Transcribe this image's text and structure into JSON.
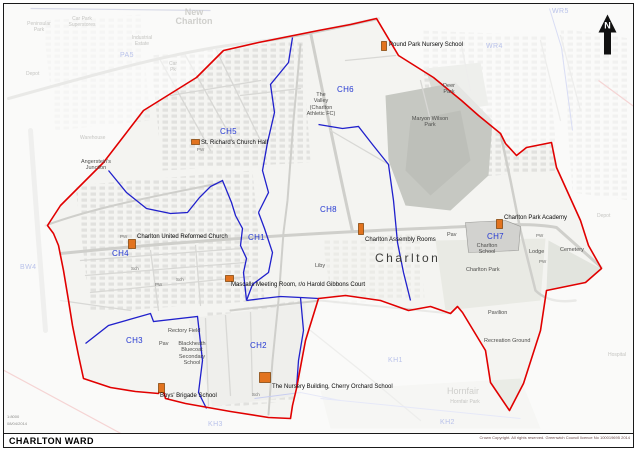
{
  "title_bar": {
    "title": "CHARLTON WARD",
    "copyright": "Crown Copyright. All rights reserved. Greenwich Council licence No 100019695 2014"
  },
  "meta": {
    "scale": "1:8000",
    "date": "08/04/2014"
  },
  "north": {
    "label": "N"
  },
  "districts": {
    "ch1": "CH1",
    "ch2": "CH2",
    "ch3": "CH3",
    "ch4": "CH4",
    "ch5": "CH5",
    "ch6": "CH6",
    "ch7": "CH7",
    "ch8": "CH8"
  },
  "outside_districts": {
    "pa5": "PA5",
    "wr4": "WR4",
    "wr5": "WR5",
    "bw4": "BW4",
    "kh1": "KH1",
    "kh2": "KH2",
    "kh3": "KH3"
  },
  "pois": {
    "pound_park": "Pound Park Nursery School",
    "st_richards": "St. Richard's Church Hall",
    "charlton_united": "Charlton United Reformed Church",
    "assembly": "Charlton Assembly Rooms",
    "mascalls": "Mascalls Meeting Room, r/o Harold Gibbons Court",
    "academy": "Charlton Park Academy",
    "boys": "Boys' Brigade School",
    "nursery": "The Nursery Building, Cherry Orchard School"
  },
  "places": {
    "deer_park": "Deer\nPark",
    "maryon": "Maryon Wilson\nPark",
    "valley": "The\nValley\n(Charlton\nAthletic FC)",
    "angersteins": "Angerstein's\nJunction",
    "rectory": "Rectory Field",
    "blackheath": "Blackheath\nBluecoat\nSecondary\nSchool",
    "pav": "Pav",
    "charlton_school": "Charlton\nSchool",
    "charlton_park": "Charlton Park",
    "cemetery": "Cemetery",
    "lodge": "Lodge",
    "pavilion": "Pavilion",
    "recreation": "Recreation Ground",
    "liby": "Liby",
    "charlton_big": "Charlton"
  },
  "faint": {
    "new_charlton": "New\nCharlton",
    "peninsular_park": "Peninsular\nPark",
    "car_park": "Car Park\nSuperstores",
    "industrial_estate": "Industrial\nEstate",
    "depot_left": "Depot",
    "depot_right": "Depot",
    "car_pk": "Car\nPk",
    "warehouse": "Warehouse",
    "hospital": "Hospital",
    "hornfair": "Hornfair",
    "hornfair_park": "Hornfair Park"
  },
  "small": {
    "pw": "PW",
    "sch": "Sch"
  },
  "colors": {
    "ward_boundary": "#e10000",
    "district_boundary": "#2020cc",
    "district_label": "#2438d2",
    "poi_marker": "#e2731f"
  }
}
